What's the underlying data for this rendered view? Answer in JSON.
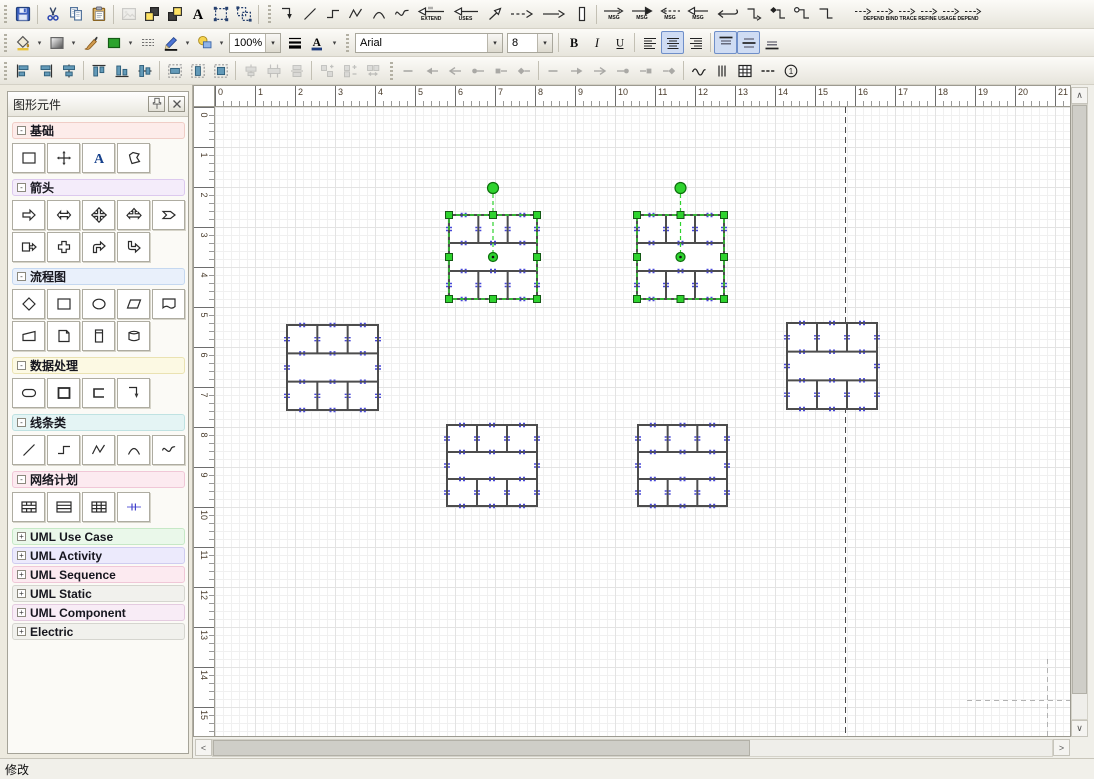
{
  "status": {
    "text": "修改"
  },
  "combos": {
    "font": "Arial",
    "font_size": "8",
    "zoom": "100%"
  },
  "labels": {
    "extend": "EXTEND",
    "uses": "USES",
    "msg": "MSG",
    "deps": [
      "DEPEND",
      "BIND",
      "TRACE",
      "REFINE",
      "USAGE",
      "DEPEND"
    ],
    "letter_a": "A",
    "bold": "B",
    "italic": "I",
    "underline": "U",
    "one": "1"
  },
  "icons": {
    "dropdown": "▾",
    "scroll_up": "∧",
    "scroll_down": "∨",
    "scroll_left": "<",
    "scroll_right": ">",
    "collapse": "-",
    "expand": "+"
  },
  "toolbars": {
    "row1": [
      {
        "buttons": [
          {
            "n": "save",
            "i": "save"
          },
          {
            "sep": 1
          },
          {
            "n": "cut",
            "i": "cut"
          },
          {
            "n": "copy",
            "i": "copy"
          },
          {
            "n": "paste",
            "i": "paste"
          },
          {
            "sep": 1
          },
          {
            "n": "insert-image",
            "i": "image",
            "dis": 1
          },
          {
            "n": "bring-to-front",
            "i": "bring-front"
          },
          {
            "n": "send-to-back",
            "i": "send-back"
          },
          {
            "n": "text-tool",
            "i": "text-a"
          },
          {
            "n": "group",
            "i": "group"
          },
          {
            "n": "ungroup",
            "i": "ungroup"
          },
          {
            "sep": 1
          }
        ]
      },
      {
        "buttons": [
          {
            "n": "elbow-connector",
            "i": "elbow-arrow"
          },
          {
            "n": "line-tool",
            "i": "line-tool"
          },
          {
            "n": "step-connector",
            "i": "step-tool"
          },
          {
            "n": "zigzag-tool",
            "i": "zigzag-tool"
          },
          {
            "n": "arc-tool",
            "i": "arc-tool"
          },
          {
            "n": "wave-tool",
            "i": "wave-tool"
          },
          {
            "n": "extend-relation",
            "i": "extend-arrow",
            "labKey": "extend"
          },
          {
            "n": "uses-relation",
            "i": "uses-arrow",
            "labKey": "uses"
          },
          {
            "n": "diagonal-arrow",
            "i": "diag-arrow"
          },
          {
            "n": "dashed-arrow",
            "i": "dashed-arrow"
          },
          {
            "n": "solid-arrow",
            "i": "solid-arrow"
          },
          {
            "n": "lifeline",
            "i": "lifeline"
          },
          {
            "sep": 1
          },
          {
            "n": "message-arrow-open",
            "i": "msg-r-open",
            "labKey": "msg"
          },
          {
            "n": "message-arrow-filled",
            "i": "msg-r-filled",
            "labKey": "msg"
          },
          {
            "n": "message-arrow-dashed",
            "i": "msg-l-dashed",
            "labKey": "msg"
          },
          {
            "n": "message-arrow-left",
            "i": "msg-l-open",
            "labKey": "msg"
          },
          {
            "n": "return-arrow",
            "i": "return-arrow"
          },
          {
            "n": "z-connector-arrow",
            "i": "z-arrow"
          },
          {
            "n": "z-connector-diamond",
            "i": "z-diamond"
          },
          {
            "n": "z-connector-circle",
            "i": "z-circle"
          },
          {
            "n": "z-connector",
            "i": "z-plain"
          },
          {
            "n": "uml-relations",
            "deps": 1
          }
        ]
      }
    ],
    "row2": [
      {
        "buttons": [
          {
            "n": "fill-color",
            "i": "fill-bucket",
            "dd": 1
          },
          {
            "n": "gradient-fill",
            "i": "gradient-rect",
            "dd": 1
          },
          {
            "n": "format-brush",
            "i": "brush"
          },
          {
            "n": "shape-fill",
            "i": "green-rect",
            "dd": 1
          },
          {
            "n": "hatch-style",
            "i": "hatch"
          },
          {
            "n": "line-color",
            "i": "pen",
            "dd": 1
          },
          {
            "n": "shadow-style",
            "i": "bubble",
            "dd": 1
          },
          {
            "combo": "zoom",
            "n": "zoom-level",
            "w": 52
          },
          {
            "n": "line-width",
            "i": "line-width"
          },
          {
            "n": "font-color",
            "i": "font-color",
            "dd": 1
          }
        ]
      },
      {
        "buttons": [
          {
            "combo": "font",
            "n": "font-family",
            "w": 148
          },
          {
            "combo": "font_size",
            "n": "font-size",
            "w": 46
          },
          {
            "sep": 1
          },
          {
            "n": "bold",
            "i": "bold"
          },
          {
            "n": "italic",
            "i": "italic"
          },
          {
            "n": "underline",
            "i": "underline"
          },
          {
            "sep": 1
          },
          {
            "n": "align-left",
            "i": "align-left"
          },
          {
            "n": "align-center",
            "i": "align-center",
            "act": 1
          },
          {
            "n": "align-right",
            "i": "align-right"
          },
          {
            "sep": 1
          },
          {
            "n": "valign-top",
            "i": "valign-top",
            "act": 1
          },
          {
            "n": "valign-middle",
            "i": "valign-middle",
            "act": 1
          },
          {
            "n": "valign-bottom",
            "i": "valign-bottom"
          }
        ]
      }
    ],
    "row3": [
      {
        "buttons": [
          {
            "n": "align-objects-left",
            "i": "oal"
          },
          {
            "n": "align-objects-right",
            "i": "oar"
          },
          {
            "n": "align-objects-center",
            "i": "oac"
          },
          {
            "sep": 1
          },
          {
            "n": "align-objects-top",
            "i": "oat"
          },
          {
            "n": "align-objects-bottom",
            "i": "oab"
          },
          {
            "n": "align-objects-middle",
            "i": "oam"
          },
          {
            "sep": 1
          },
          {
            "n": "same-width",
            "i": "same-w"
          },
          {
            "n": "same-height",
            "i": "same-h"
          },
          {
            "n": "same-size",
            "i": "same-size"
          },
          {
            "sep": 1
          },
          {
            "n": "distribute-center",
            "i": "dist-h",
            "dis": 1
          },
          {
            "n": "distribute-horizontal",
            "i": "dist-h2",
            "dis": 1
          },
          {
            "n": "distribute-middle",
            "i": "dist-h3",
            "dis": 1
          },
          {
            "sep": 1
          },
          {
            "n": "space-vertical",
            "i": "dist-v",
            "dis": 1
          },
          {
            "n": "space-vertical-add",
            "i": "dist-v2",
            "dis": 1
          },
          {
            "n": "space-vertical-remove",
            "i": "dist-v3",
            "dis": 1
          }
        ]
      },
      {
        "buttons": [
          {
            "n": "line-begin-none",
            "i": "cap-none",
            "dis": 1
          },
          {
            "n": "line-begin-arrow",
            "i": "cap-arrow-l",
            "dis": 1
          },
          {
            "n": "line-begin-open-arrow",
            "i": "cap-open-l",
            "dis": 1
          },
          {
            "n": "line-begin-circle",
            "i": "cap-circle-l",
            "dis": 1
          },
          {
            "n": "line-begin-square",
            "i": "cap-square-l",
            "dis": 1
          },
          {
            "n": "line-begin-diamond",
            "i": "cap-diamond-l",
            "dis": 1
          },
          {
            "sep": 1
          },
          {
            "n": "line-end-none",
            "i": "cap-none",
            "dis": 1
          },
          {
            "n": "line-end-arrow",
            "i": "cap-arrow-r",
            "dis": 1
          },
          {
            "n": "line-end-open-arrow",
            "i": "cap-open-r",
            "dis": 1
          },
          {
            "n": "line-end-circle",
            "i": "cap-circle-r",
            "dis": 1
          },
          {
            "n": "line-end-square",
            "i": "cap-square-r",
            "dis": 1
          },
          {
            "n": "line-end-diamond",
            "i": "cap-diamond-r",
            "dis": 1
          },
          {
            "sep": 1
          },
          {
            "n": "line-style-wave",
            "i": "line-wave"
          },
          {
            "n": "line-style-parallel",
            "i": "line-parallel"
          },
          {
            "n": "show-grid",
            "i": "grid-icon"
          },
          {
            "n": "line-style-dash",
            "i": "line-dash"
          },
          {
            "n": "numbering",
            "i": "circled-one"
          }
        ]
      }
    ]
  },
  "sidebar": {
    "title": "图形元件",
    "sections": [
      {
        "label": "基础",
        "expanded": true,
        "theme": "pink",
        "items": [
          "s-rect",
          "s-move",
          "s-text",
          "s-polygon"
        ]
      },
      {
        "label": "箭头",
        "expanded": true,
        "theme": "purple",
        "items": [
          "s-arrow-r",
          "s-arrow-lr",
          "s-arrow-cross",
          "s-arrow-tri",
          "s-chevron",
          "s-rect-arrow",
          "s-plus-arrow",
          "s-corner-up",
          "s-corner-dn"
        ]
      },
      {
        "label": "流程图",
        "expanded": true,
        "theme": "blue",
        "items": [
          "s-diamond",
          "s-rect",
          "s-ellipse",
          "s-para",
          "s-doc",
          "s-trap",
          "s-page",
          "s-card",
          "s-cyl"
        ]
      },
      {
        "label": "数据处理",
        "expanded": true,
        "theme": "yellow",
        "items": [
          "s-stadium",
          "s-rect2",
          "s-bracket",
          "s-elbow"
        ]
      },
      {
        "label": "线条类",
        "expanded": true,
        "theme": "cyan",
        "items": [
          "s-line",
          "s-step",
          "s-zigzag",
          "s-arc",
          "s-wave"
        ]
      },
      {
        "label": "网络计划",
        "expanded": true,
        "theme": "rose",
        "items": [
          "s-wall",
          "s-hlines",
          "s-grid",
          "s-ticks"
        ]
      },
      {
        "label": "UML Use Case",
        "expanded": false,
        "theme": "green",
        "items": []
      },
      {
        "label": "UML Activity",
        "expanded": false,
        "theme": "violet",
        "items": []
      },
      {
        "label": "UML Sequence",
        "expanded": false,
        "theme": "rose",
        "items": []
      },
      {
        "label": "UML Static",
        "expanded": false,
        "theme": "gray",
        "items": []
      },
      {
        "label": "UML Component",
        "expanded": false,
        "theme": "mauve",
        "items": []
      },
      {
        "label": "Electric",
        "expanded": false,
        "theme": "gray",
        "items": []
      }
    ]
  },
  "ruler": {
    "h": [
      "0",
      "1",
      "2",
      "3",
      "4",
      "5",
      "6",
      "7",
      "8",
      "9",
      "10",
      "11",
      "12",
      "13",
      "14",
      "15",
      "16",
      "17",
      "18",
      "19",
      "20",
      "21"
    ],
    "v": [
      "0",
      "1",
      "2",
      "3",
      "4",
      "5",
      "6",
      "7",
      "8",
      "9",
      "10",
      "11",
      "12",
      "13",
      "14",
      "15"
    ]
  },
  "canvas": {
    "page_line_x": 630,
    "colors": {
      "shape_stroke": "#4d4d4d",
      "connection_mark": "#4848d8",
      "selection": "#2ed32e",
      "selection_dark": "#0c6e0c"
    },
    "shapes": [
      {
        "x": 234,
        "y": 108,
        "w": 88,
        "h": 84,
        "selected": true
      },
      {
        "x": 422,
        "y": 108,
        "w": 87,
        "h": 84,
        "selected": true
      },
      {
        "x": 72,
        "y": 218,
        "w": 91,
        "h": 85,
        "selected": false
      },
      {
        "x": 572,
        "y": 216,
        "w": 90,
        "h": 86,
        "selected": false
      },
      {
        "x": 232,
        "y": 318,
        "w": 90,
        "h": 81,
        "selected": false
      },
      {
        "x": 423,
        "y": 318,
        "w": 89,
        "h": 81,
        "selected": false
      }
    ]
  }
}
